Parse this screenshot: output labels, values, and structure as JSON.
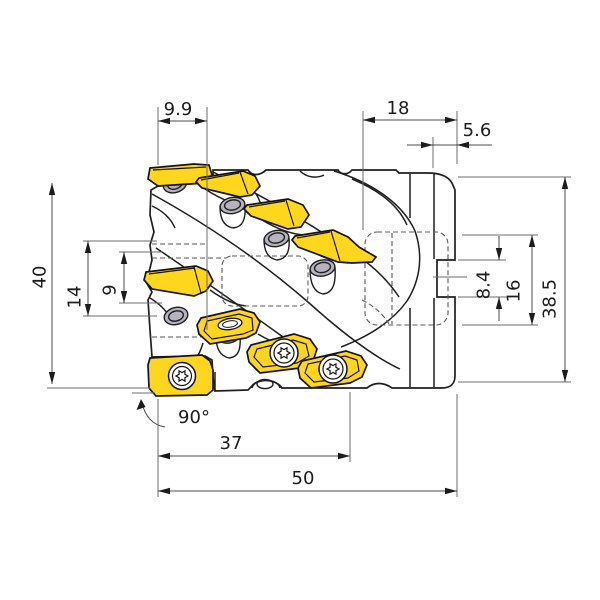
{
  "drawing": {
    "title": "indexable helical milling cutter side view",
    "units": "mm (implied)",
    "colors": {
      "body": "#b6b3bf",
      "insert": "#ffd61e",
      "outline": "#1f1f1f",
      "dimension": "#1c1c1c"
    },
    "icons": {
      "screw": "torx-screw-icon"
    },
    "dims": {
      "d99": {
        "label": "9.9",
        "orientation": "horizontal",
        "measures": "first insert axial offset"
      },
      "d18": {
        "label": "18",
        "orientation": "horizontal",
        "measures": "rear collar width"
      },
      "d56": {
        "label": "5.6",
        "orientation": "horizontal",
        "measures": "end collar width"
      },
      "d40": {
        "label": "40",
        "orientation": "vertical",
        "measures": "overall height left"
      },
      "d14": {
        "label": "14",
        "orientation": "vertical",
        "measures": "mid feature height"
      },
      "d9": {
        "label": "9",
        "orientation": "vertical",
        "measures": "inner feature height"
      },
      "d84": {
        "label": "8.4",
        "orientation": "vertical",
        "measures": "drive notch height"
      },
      "d16": {
        "label": "16",
        "orientation": "vertical",
        "measures": "hidden slot height"
      },
      "d385": {
        "label": "38.5",
        "orientation": "vertical",
        "measures": "body height right"
      },
      "a90": {
        "label": "90°",
        "orientation": "horizontal",
        "measures": "corner angle"
      },
      "d37": {
        "label": "37",
        "orientation": "horizontal",
        "measures": "cutting length"
      },
      "d50": {
        "label": "50",
        "orientation": "horizontal",
        "measures": "overall length"
      }
    }
  }
}
